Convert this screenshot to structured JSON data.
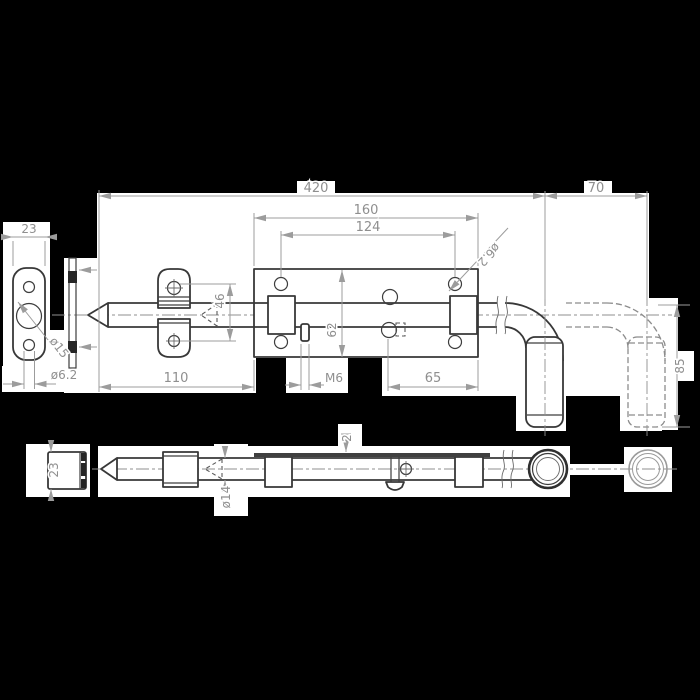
{
  "drawing": {
    "type": "technical-drawing",
    "subject": "Gate spring bolt latch with keeper plate - orthographic views",
    "colors": {
      "background": "#000000",
      "paper": "#ffffff",
      "outline": "#383838",
      "dimension_lines": "#9c9c9c",
      "text": "#8f8f8f"
    },
    "top_view": {
      "name": "top view",
      "dims": {
        "total_length": "420",
        "handle_travel": "70",
        "plate_length": "160",
        "hole_spacing": "124",
        "hole_diameter": "ø6.2",
        "staple_hole_offset": "46",
        "plate_width": "62",
        "edge_distance": "65",
        "tip_length": "110",
        "thread": "M6",
        "handle_drop": "85"
      }
    },
    "keeper_view": {
      "name": "keeper plate detail",
      "dims": {
        "plate_width": "23",
        "slot_diameter": "ø15",
        "hole_diameter": "ø6.2"
      }
    },
    "side_view": {
      "name": "bolt side elevation",
      "dims": {
        "square_size": "23",
        "rod_diameter": "ø14",
        "plate_thickness": "2"
      }
    }
  }
}
